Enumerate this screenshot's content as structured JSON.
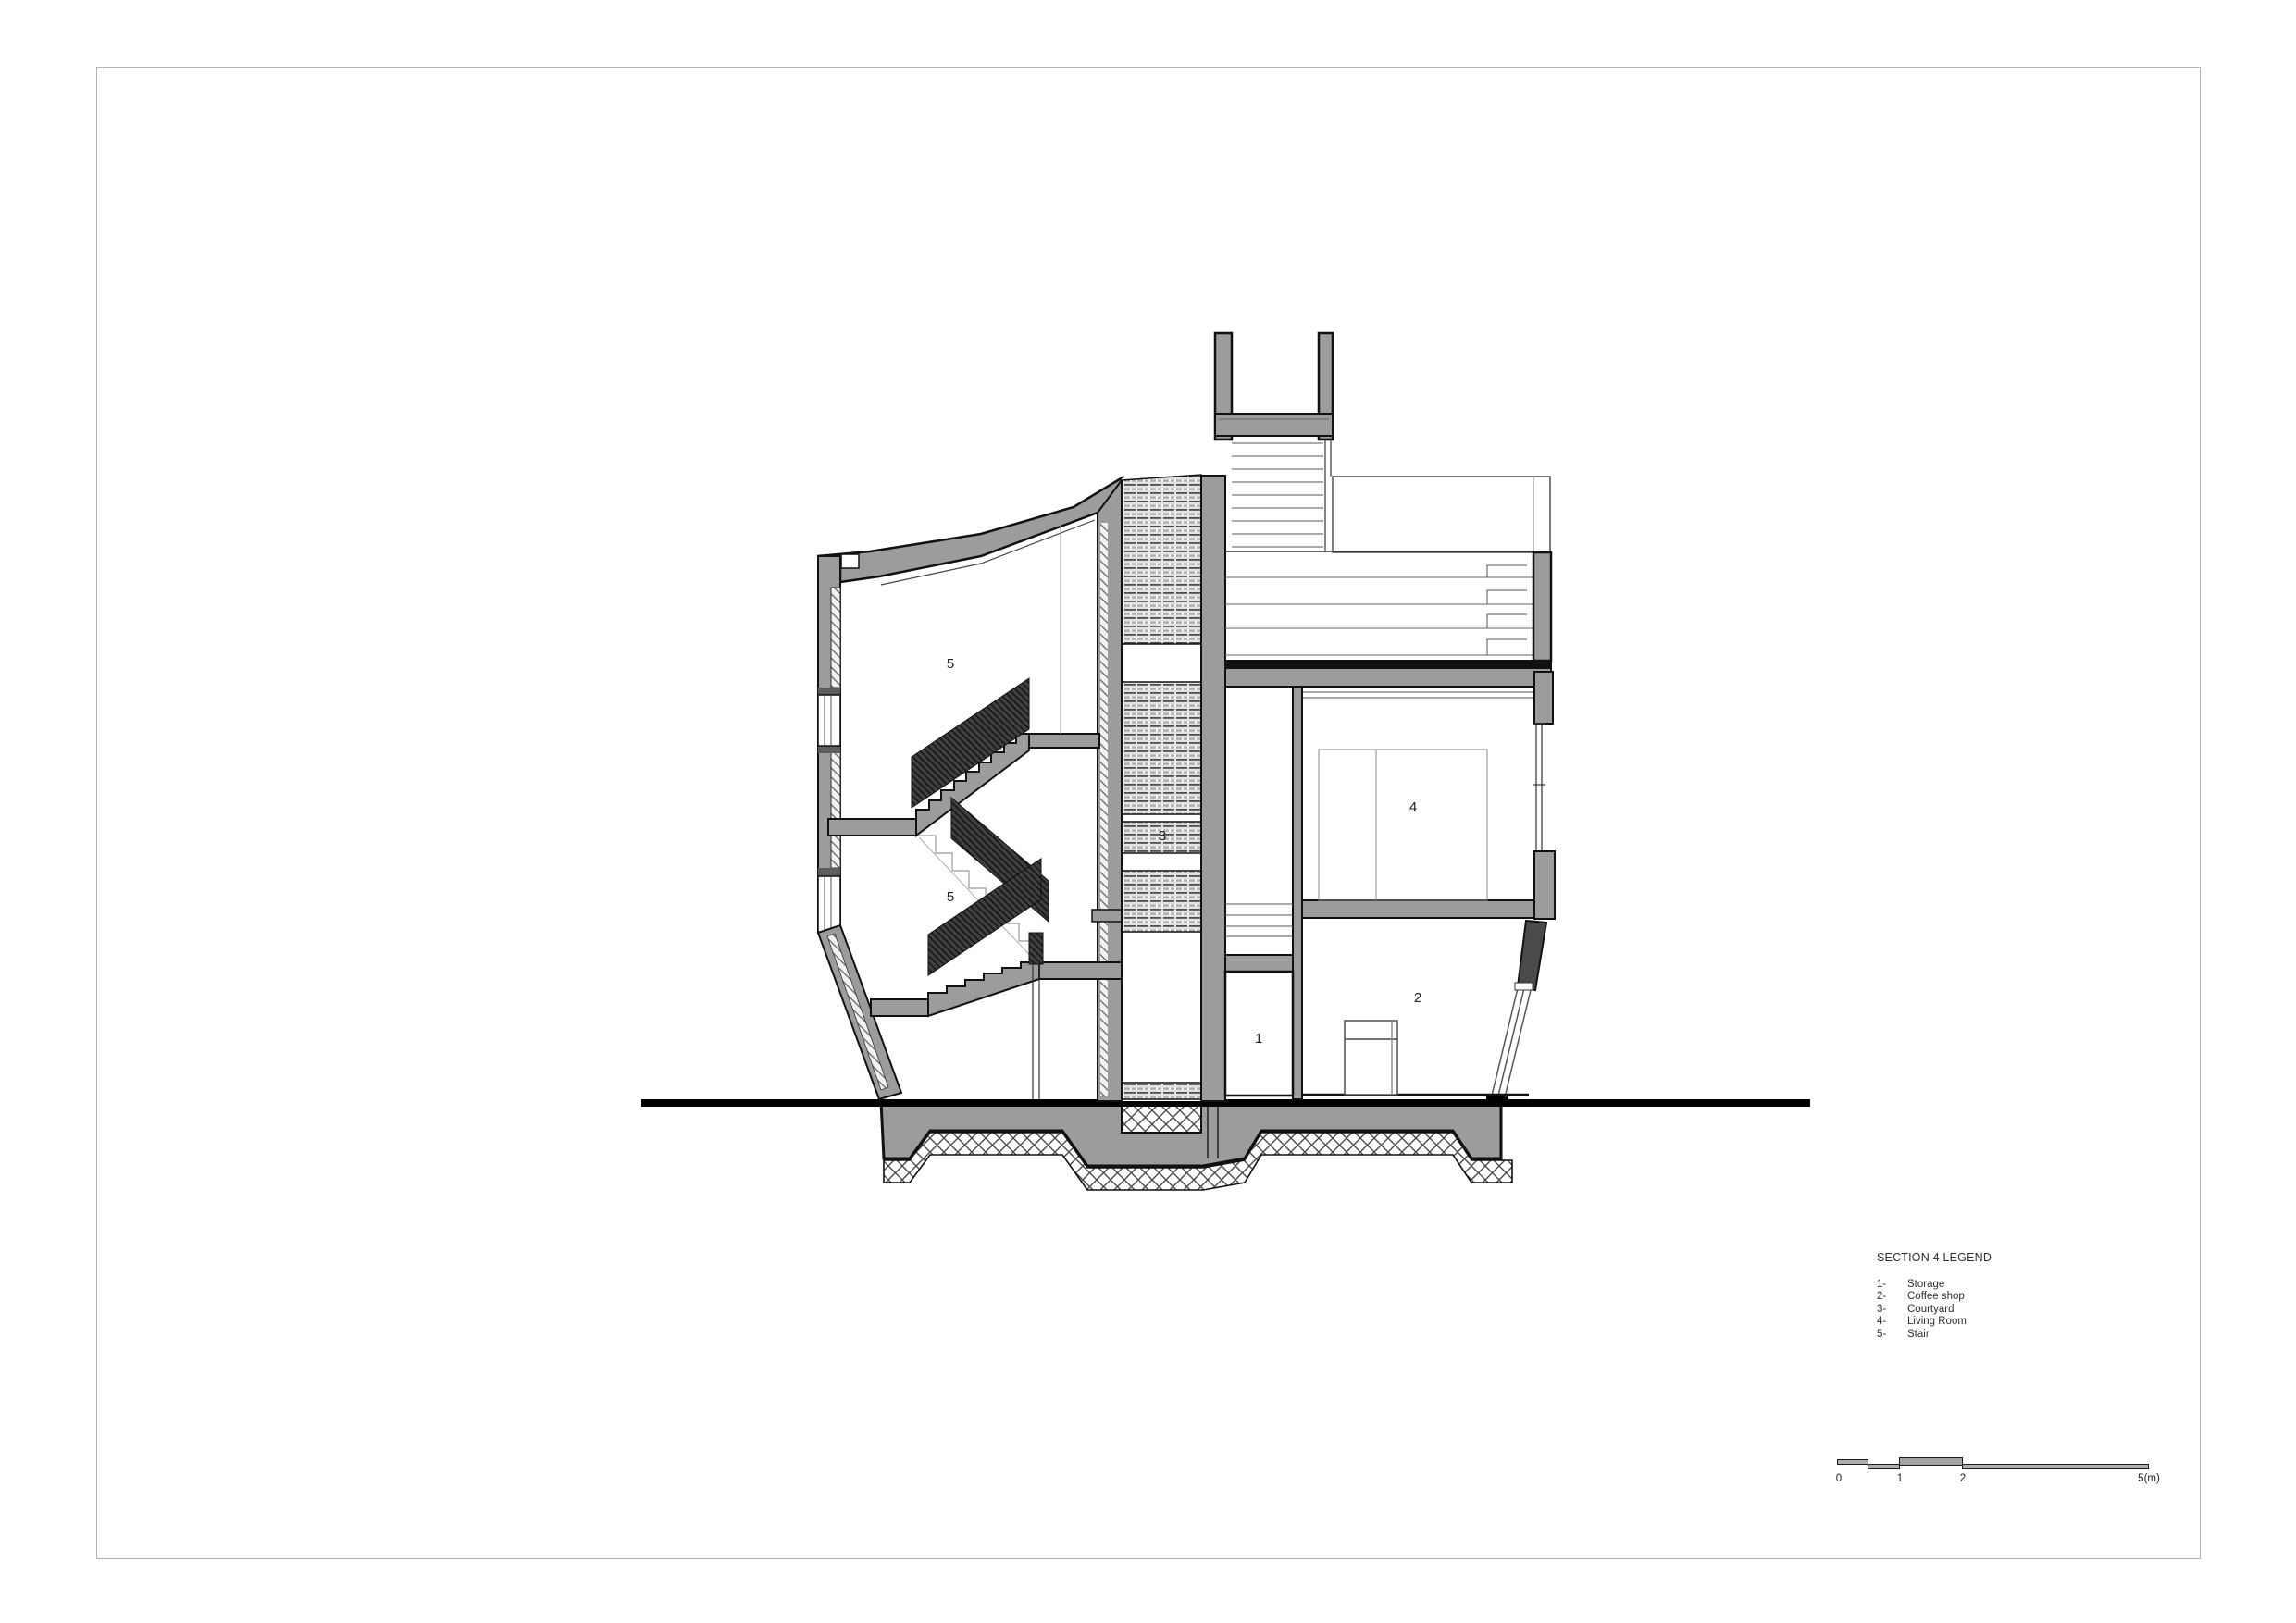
{
  "drawing": {
    "type": "architectural-section",
    "labels": {
      "stair_upper": "5",
      "stair_lower": "5",
      "courtyard": "3",
      "living_room": "4",
      "storage": "1",
      "coffee_shop": "2"
    }
  },
  "legend": {
    "title": "SECTION 4 LEGEND",
    "items": [
      {
        "num": "1-",
        "name": "Storage"
      },
      {
        "num": "2-",
        "name": "Coffee shop"
      },
      {
        "num": "3-",
        "name": "Courtyard"
      },
      {
        "num": "4-",
        "name": "Living Room"
      },
      {
        "num": "5-",
        "name": "Stair"
      }
    ]
  },
  "scale_bar": {
    "ticks": [
      "0",
      "1",
      "2",
      "5(m)"
    ]
  },
  "colors": {
    "wall_gray": "#9c9c9c",
    "outline_black": "#111111",
    "dark_rail_band": "#3a3a3a",
    "ground_line": "#000000",
    "page_border": "#b3b3b3",
    "screen_band_bg": "#e3e3e3"
  }
}
